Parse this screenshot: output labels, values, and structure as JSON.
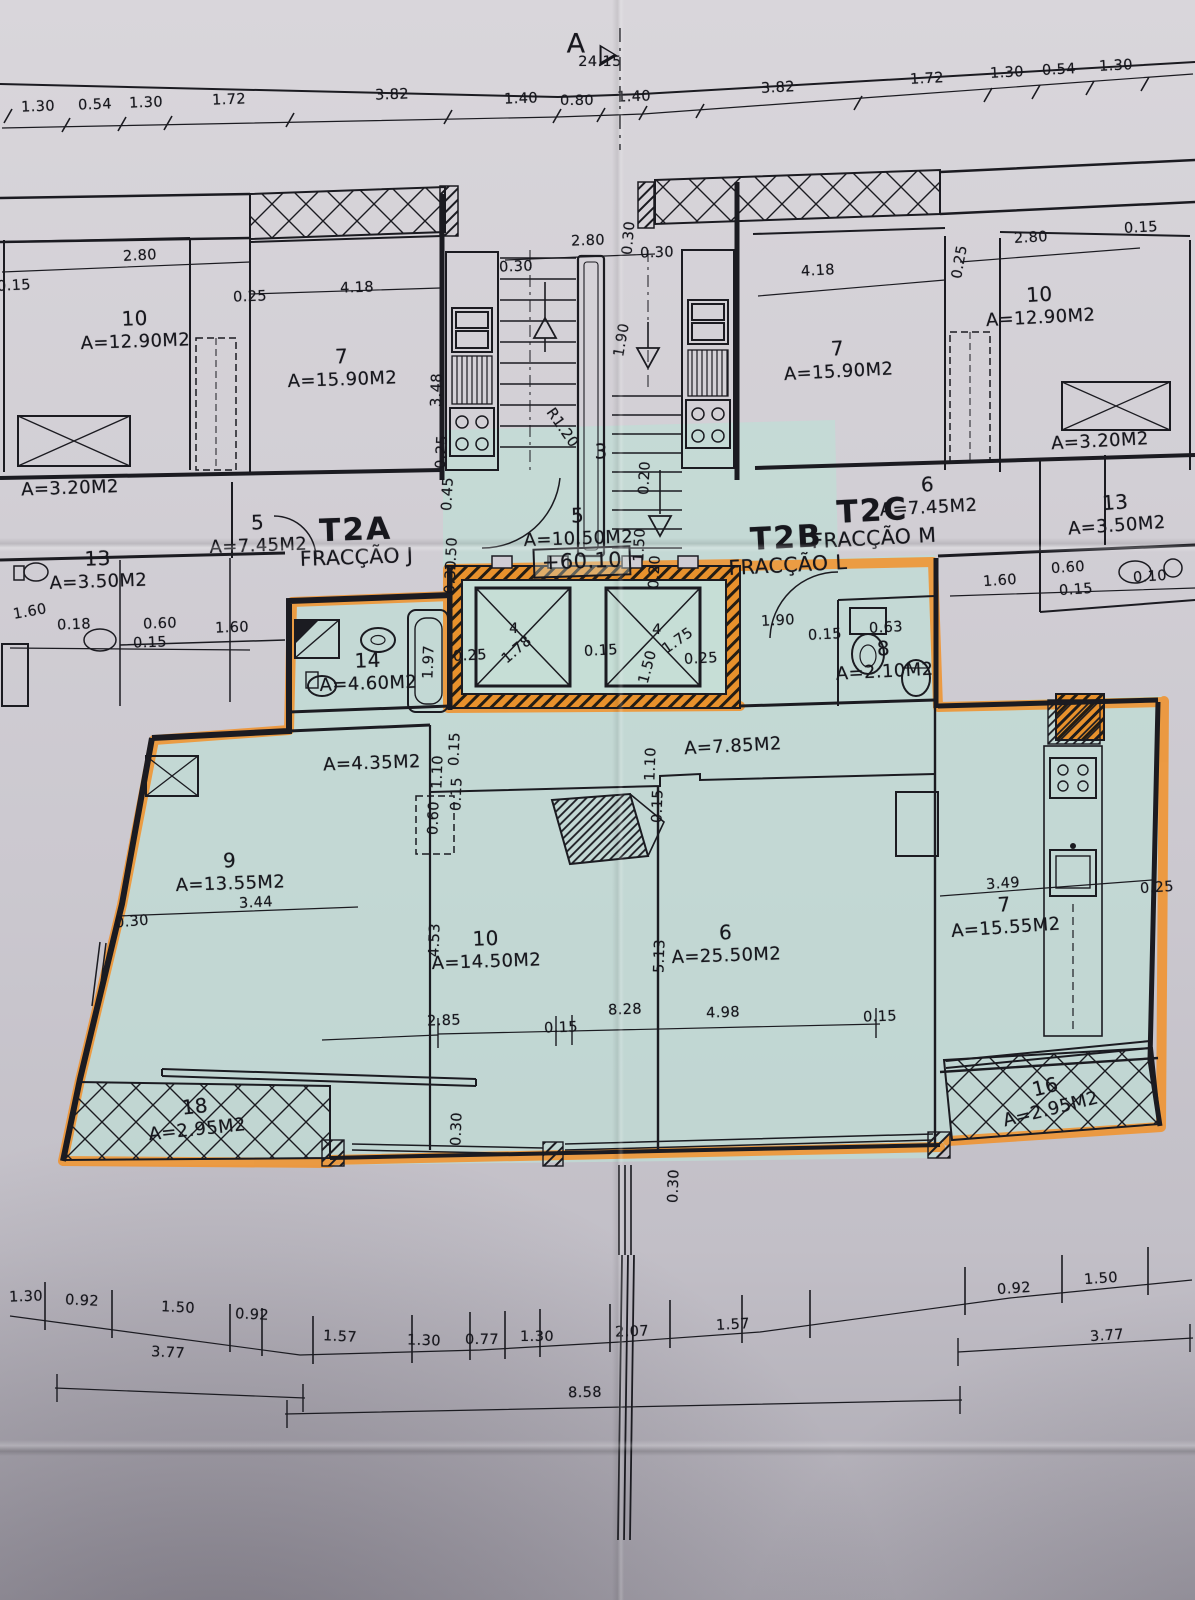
{
  "meta": {
    "section_marker": "A",
    "level_marker": "+60.10"
  },
  "colors": {
    "paper": "#cfccd3",
    "highlight_teal": "#bfded5",
    "highlight_orange": "#f0932f",
    "ink": "#1b1b21"
  },
  "fractions": [
    {
      "c": "T2A",
      "f": "FRACÇÃO J",
      "x": 356,
      "y": 541,
      "r": -2
    },
    {
      "c": "T2B",
      "f": "FRACÇÃO L",
      "x": 787,
      "y": 549,
      "r": -3
    },
    {
      "c": "T2C",
      "f": "FRACÇÃO M",
      "x": 873,
      "y": 522,
      "r": -3
    }
  ],
  "rooms": [
    {
      "n": "10",
      "a": "A=12.90M2",
      "x": 135,
      "y": 330,
      "r": -2
    },
    {
      "n": "7",
      "a": "A=15.90M2",
      "x": 342,
      "y": 368,
      "r": -2
    },
    {
      "n": "",
      "a": "A=3.20M2",
      "x": 70,
      "y": 489,
      "r": -2
    },
    {
      "n": "13",
      "a": "A=3.50M2",
      "x": 98,
      "y": 570,
      "r": -2
    },
    {
      "n": "5",
      "a": "A=7.45M2",
      "x": 258,
      "y": 534,
      "r": -2
    },
    {
      "n": "5",
      "a": "A=10.50M2",
      "x": 578,
      "y": 527,
      "r": -2
    },
    {
      "n": "3",
      "a": "",
      "x": 601,
      "y": 452,
      "r": 0
    },
    {
      "n": "7",
      "a": "A=15.90M2",
      "x": 838,
      "y": 360,
      "r": -3
    },
    {
      "n": "10",
      "a": "A=12.90M2",
      "x": 1040,
      "y": 306,
      "r": -3
    },
    {
      "n": "",
      "a": "A=3.20M2",
      "x": 1100,
      "y": 442,
      "r": -3
    },
    {
      "n": "13",
      "a": "A=3.50M2",
      "x": 1116,
      "y": 514,
      "r": -4
    },
    {
      "n": "6",
      "a": "A=7.45M2",
      "x": 928,
      "y": 496,
      "r": -3
    },
    {
      "n": "14",
      "a": "A=4.60M2",
      "x": 368,
      "y": 672,
      "r": -2
    },
    {
      "n": "8",
      "a": "A=2.10M2",
      "x": 884,
      "y": 660,
      "r": -3
    },
    {
      "n": "",
      "a": "A=4.35M2",
      "x": 372,
      "y": 764,
      "r": -2
    },
    {
      "n": "",
      "a": "A=7.85M2",
      "x": 733,
      "y": 747,
      "r": -3
    },
    {
      "n": "9",
      "a": "A=13.55M2",
      "x": 230,
      "y": 872,
      "r": -2
    },
    {
      "n": "10",
      "a": "A=14.50M2",
      "x": 486,
      "y": 950,
      "r": -2
    },
    {
      "n": "6",
      "a": "A=25.50M2",
      "x": 726,
      "y": 944,
      "r": -2
    },
    {
      "n": "7",
      "a": "A=15.55M2",
      "x": 1005,
      "y": 916,
      "r": -4
    },
    {
      "n": "18",
      "a": "A=2.95M2",
      "x": 196,
      "y": 1118,
      "r": -6
    },
    {
      "n": "16",
      "a": "A=2.95M2",
      "x": 1048,
      "y": 1098,
      "r": -14
    }
  ],
  "dims": [
    {
      "t": "1.30",
      "x": 38,
      "y": 107,
      "r": -2
    },
    {
      "t": "0.54",
      "x": 95,
      "y": 105,
      "r": -2
    },
    {
      "t": "1.30",
      "x": 146,
      "y": 103,
      "r": -2
    },
    {
      "t": "1.72",
      "x": 229,
      "y": 100,
      "r": -2
    },
    {
      "t": "3.82",
      "x": 392,
      "y": 95,
      "r": -2
    },
    {
      "t": "24.15",
      "x": 600,
      "y": 62,
      "r": 0
    },
    {
      "t": "1.40",
      "x": 521,
      "y": 99,
      "r": -2
    },
    {
      "t": "0.80",
      "x": 577,
      "y": 101,
      "r": 0
    },
    {
      "t": "1.40",
      "x": 634,
      "y": 97,
      "r": -2
    },
    {
      "t": "3.82",
      "x": 778,
      "y": 88,
      "r": -3
    },
    {
      "t": "1.72",
      "x": 927,
      "y": 79,
      "r": -3
    },
    {
      "t": "1.30",
      "x": 1007,
      "y": 73,
      "r": -3
    },
    {
      "t": "0.54",
      "x": 1059,
      "y": 70,
      "r": -3
    },
    {
      "t": "1.30",
      "x": 1116,
      "y": 66,
      "r": -3
    },
    {
      "t": "0.15",
      "x": 14,
      "y": 286,
      "r": -3
    },
    {
      "t": "2.80",
      "x": 140,
      "y": 256,
      "r": -3
    },
    {
      "t": "0.25",
      "x": 250,
      "y": 297,
      "r": -2
    },
    {
      "t": "4.18",
      "x": 357,
      "y": 288,
      "r": -2
    },
    {
      "t": "3.48",
      "x": 437,
      "y": 390,
      "r": -88
    },
    {
      "t": "2.80",
      "x": 588,
      "y": 241,
      "r": -2
    },
    {
      "t": "0.30",
      "x": 516,
      "y": 267,
      "r": -2
    },
    {
      "t": "0.30",
      "x": 629,
      "y": 238,
      "r": -85
    },
    {
      "t": "0.30",
      "x": 657,
      "y": 253,
      "r": -2
    },
    {
      "t": "1.90",
      "x": 622,
      "y": 340,
      "r": -80
    },
    {
      "t": "R1.20",
      "x": 562,
      "y": 428,
      "r": 55
    },
    {
      "t": "4.18",
      "x": 818,
      "y": 271,
      "r": -3
    },
    {
      "t": "0.25",
      "x": 960,
      "y": 262,
      "r": -80
    },
    {
      "t": "2.80",
      "x": 1031,
      "y": 238,
      "r": -3
    },
    {
      "t": "0.15",
      "x": 1141,
      "y": 228,
      "r": -3
    },
    {
      "t": "1.60",
      "x": 30,
      "y": 612,
      "r": -10
    },
    {
      "t": "0.18",
      "x": 74,
      "y": 625,
      "r": -2
    },
    {
      "t": "0.60",
      "x": 160,
      "y": 624,
      "r": -2
    },
    {
      "t": "0.15",
      "x": 150,
      "y": 643,
      "r": -2
    },
    {
      "t": "1.60",
      "x": 232,
      "y": 628,
      "r": -2
    },
    {
      "t": "0.25",
      "x": 442,
      "y": 452,
      "r": -87
    },
    {
      "t": "0.45",
      "x": 448,
      "y": 494,
      "r": -87
    },
    {
      "t": "1.50",
      "x": 452,
      "y": 554,
      "r": -87
    },
    {
      "t": "0.30",
      "x": 451,
      "y": 577,
      "r": -87
    },
    {
      "t": "0.20",
      "x": 645,
      "y": 478,
      "r": -87
    },
    {
      "t": "1.50",
      "x": 640,
      "y": 545,
      "r": -87
    },
    {
      "t": "0.20",
      "x": 655,
      "y": 572,
      "r": -87
    },
    {
      "t": "1.60",
      "x": 1000,
      "y": 581,
      "r": -4
    },
    {
      "t": "0.60",
      "x": 1068,
      "y": 568,
      "r": -4
    },
    {
      "t": "0.15",
      "x": 1076,
      "y": 590,
      "r": -4
    },
    {
      "t": "0.10",
      "x": 1150,
      "y": 577,
      "r": -4
    },
    {
      "t": "1.97",
      "x": 429,
      "y": 662,
      "r": -88
    },
    {
      "t": "0.25",
      "x": 470,
      "y": 656,
      "r": -3
    },
    {
      "t": "4",
      "x": 514,
      "y": 629,
      "r": 0
    },
    {
      "t": "1.78",
      "x": 517,
      "y": 650,
      "r": -40
    },
    {
      "t": "0.15",
      "x": 601,
      "y": 651,
      "r": -3
    },
    {
      "t": "4",
      "x": 657,
      "y": 630,
      "r": 0
    },
    {
      "t": "1.75",
      "x": 678,
      "y": 641,
      "r": -35
    },
    {
      "t": "1.50",
      "x": 648,
      "y": 667,
      "r": -75
    },
    {
      "t": "0.25",
      "x": 701,
      "y": 659,
      "r": -3
    },
    {
      "t": "1.90",
      "x": 778,
      "y": 621,
      "r": -3
    },
    {
      "t": "0.15",
      "x": 825,
      "y": 635,
      "r": -3
    },
    {
      "t": "0.63",
      "x": 886,
      "y": 628,
      "r": -3
    },
    {
      "t": "1.10",
      "x": 438,
      "y": 772,
      "r": -88
    },
    {
      "t": "0.15",
      "x": 455,
      "y": 749,
      "r": -88
    },
    {
      "t": "0.15",
      "x": 457,
      "y": 794,
      "r": -88
    },
    {
      "t": "0.60",
      "x": 434,
      "y": 818,
      "r": -88
    },
    {
      "t": "1.10",
      "x": 651,
      "y": 764,
      "r": -88
    },
    {
      "t": "0.15",
      "x": 658,
      "y": 806,
      "r": -88
    },
    {
      "t": "3.44",
      "x": 256,
      "y": 903,
      "r": -3
    },
    {
      "t": "0.30",
      "x": 132,
      "y": 922,
      "r": -5
    },
    {
      "t": "4.53",
      "x": 435,
      "y": 940,
      "r": -88
    },
    {
      "t": "2.85",
      "x": 444,
      "y": 1021,
      "r": -2
    },
    {
      "t": "0.15",
      "x": 561,
      "y": 1028,
      "r": -2
    },
    {
      "t": "8.28",
      "x": 625,
      "y": 1010,
      "r": -2
    },
    {
      "t": "4.98",
      "x": 723,
      "y": 1013,
      "r": -2
    },
    {
      "t": "0.15",
      "x": 880,
      "y": 1017,
      "r": -2
    },
    {
      "t": "5.13",
      "x": 660,
      "y": 956,
      "r": -88
    },
    {
      "t": "3.49",
      "x": 1003,
      "y": 884,
      "r": -4
    },
    {
      "t": "0.25",
      "x": 1157,
      "y": 888,
      "r": -4
    },
    {
      "t": "0.30",
      "x": 457,
      "y": 1129,
      "r": -88
    },
    {
      "t": "0.30",
      "x": 674,
      "y": 1186,
      "r": -88
    },
    {
      "t": "1.30",
      "x": 26,
      "y": 1297,
      "r": -2
    },
    {
      "t": "0.92",
      "x": 82,
      "y": 1301,
      "r": 3
    },
    {
      "t": "1.50",
      "x": 178,
      "y": 1308,
      "r": 3
    },
    {
      "t": "0.92",
      "x": 252,
      "y": 1315,
      "r": 3
    },
    {
      "t": "1.57",
      "x": 340,
      "y": 1337,
      "r": 3
    },
    {
      "t": "1.30",
      "x": 424,
      "y": 1341,
      "r": 2
    },
    {
      "t": "0.77",
      "x": 482,
      "y": 1340,
      "r": 0
    },
    {
      "t": "1.30",
      "x": 537,
      "y": 1337,
      "r": 0
    },
    {
      "t": "2.07",
      "x": 632,
      "y": 1332,
      "r": -2
    },
    {
      "t": "1.57",
      "x": 733,
      "y": 1325,
      "r": -3
    },
    {
      "t": "0.92",
      "x": 1014,
      "y": 1289,
      "r": -4
    },
    {
      "t": "1.50",
      "x": 1101,
      "y": 1279,
      "r": -4
    },
    {
      "t": "3.77",
      "x": 168,
      "y": 1353,
      "r": 3
    },
    {
      "t": "8.58",
      "x": 585,
      "y": 1393,
      "r": -1
    },
    {
      "t": "3.77",
      "x": 1107,
      "y": 1336,
      "r": -4
    }
  ]
}
